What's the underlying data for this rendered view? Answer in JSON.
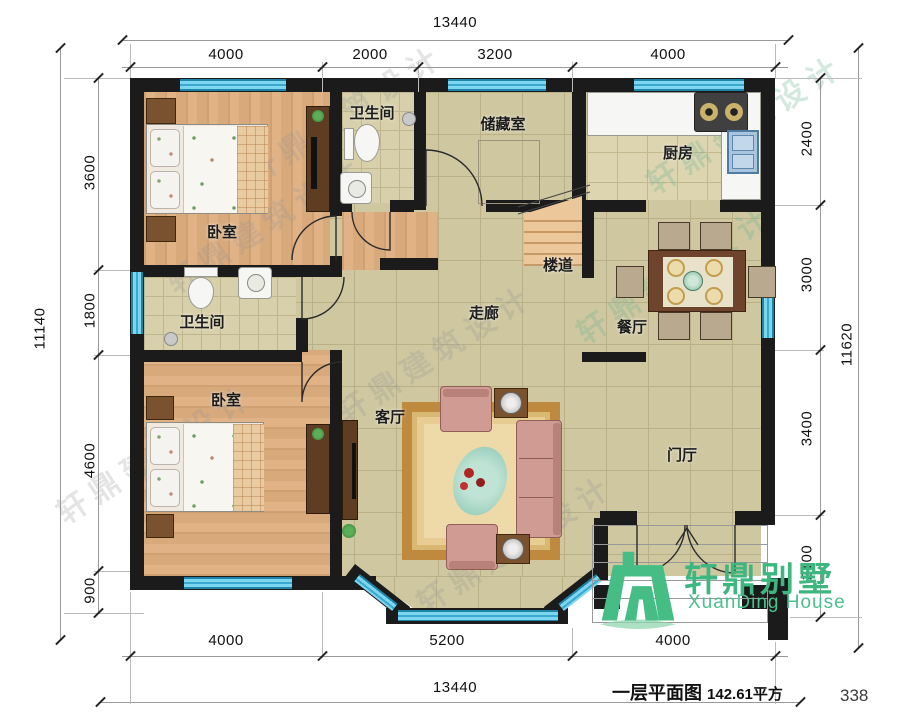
{
  "page": {
    "title": "一层平面图",
    "area_label": "142.61平方",
    "page_number": "338"
  },
  "logo": {
    "brand_cn": "轩鼎别墅",
    "brand_en": "XuanDing House"
  },
  "watermark": {
    "text": "轩鼎建筑设计"
  },
  "rooms": {
    "bedroom1": "卧室",
    "bath1": "卫生间",
    "storage": "储藏室",
    "kitchen": "厨房",
    "stairs": "楼道",
    "corridor": "走廊",
    "dining": "餐厅",
    "bath2": "卫生间",
    "bedroom2": "卧室",
    "living": "客厅",
    "foyer": "门厅"
  },
  "dimensions": {
    "top": {
      "total": "13440",
      "segments": [
        "4000",
        "2000",
        "3200",
        "4000"
      ]
    },
    "bottom": {
      "total": "13440",
      "segments": [
        "4000",
        "5200",
        "4000"
      ]
    },
    "left": {
      "total": "11140",
      "segments": [
        "3600",
        "1800",
        "4600",
        "900"
      ]
    },
    "right": {
      "total": "11620",
      "segments": [
        "2400",
        "3000",
        "3400",
        "2100"
      ]
    }
  },
  "colors": {
    "wall": "#1b1b1b",
    "window": "#6cd0ee",
    "wood_floor": "#dcae7c",
    "tile_floor": "#cfc7a0",
    "bath_tile": "#d8d0aa",
    "kitchen_tile": "#ddd5b0",
    "logo_green": "#3fbc84",
    "rug_border": "#bf8a3e",
    "sofa": "#cf9b93",
    "furniture_brown": "#6b4526"
  },
  "furniture": [
    "double-bed",
    "wardrobe",
    "nightstand",
    "toilet",
    "wash-basin",
    "shower-head",
    "gas-stove",
    "kitchen-sink",
    "counter",
    "shelf",
    "stairs",
    "dining-table",
    "dining-chair",
    "sofa",
    "armchair",
    "tea-table",
    "rug",
    "tv-cabinet",
    "entry-door",
    "porch-steps"
  ]
}
